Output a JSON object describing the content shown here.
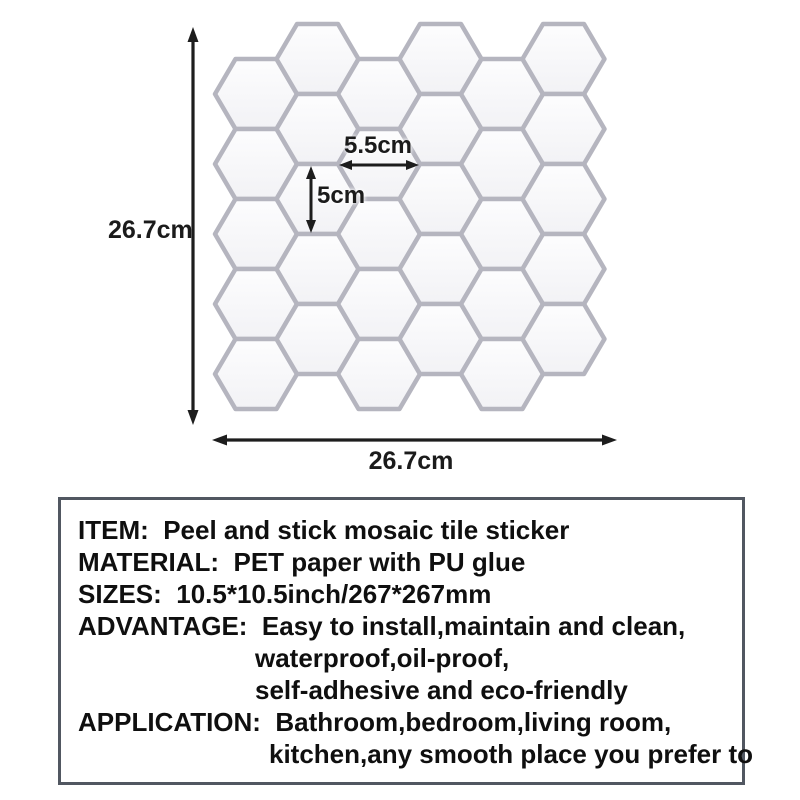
{
  "product_diagram": {
    "sheet_height_label": "26.7cm",
    "sheet_width_label": "26.7cm",
    "hex_width_label": "5.5cm",
    "hex_height_label": "5cm",
    "grid": {
      "columns": 6,
      "per_column": 5,
      "hex_w": 82,
      "hex_h": 70,
      "col_pitch": 61.5,
      "origin_x": 215,
      "high_col_y": 24,
      "low_col_y": 59,
      "tile_fill_top": "#fdfdfe",
      "tile_fill_bottom": "#f2f2f5",
      "grout_color": "#b5b5bf",
      "arrow_color": "#1d1d1d"
    }
  },
  "specs": {
    "lines": [
      {
        "text": "ITEM:  Peel and stick mosaic tile sticker"
      },
      {
        "text": "MATERIAL:  PET paper with PU glue"
      },
      {
        "text": "SIZES:  10.5*10.5inch/267*267mm"
      },
      {
        "text": "ADVANTAGE:  Easy to install,maintain and clean,"
      },
      {
        "text": "waterproof,oil-proof,"
      },
      {
        "text": "self-adhesive and eco-friendly"
      },
      {
        "text": "APPLICATION:  Bathroom,bedroom,living room,"
      },
      {
        "text": "kitchen,any smooth place you prefer to"
      }
    ]
  }
}
